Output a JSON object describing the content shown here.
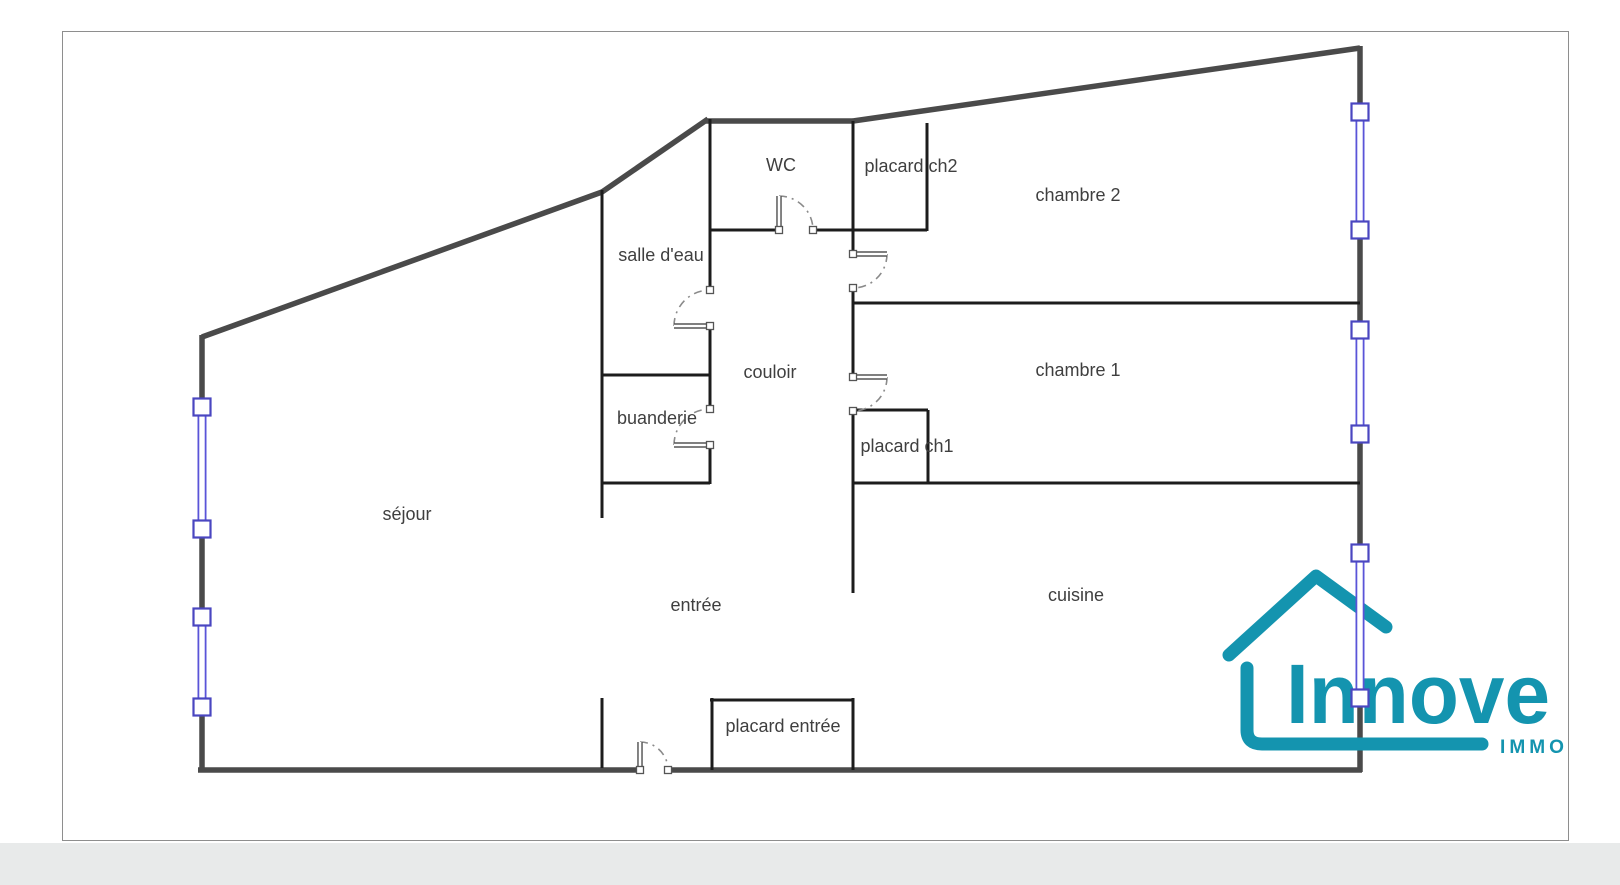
{
  "page": {
    "width": 1620,
    "height": 885,
    "background": "#ffffff",
    "bottom_band": {
      "y": 843,
      "height": 42,
      "color": "#e8eaea"
    },
    "sheet": {
      "x": 62,
      "y": 31,
      "width": 1506,
      "height": 809,
      "fill": "#ffffff",
      "border": "#8e8e8e"
    }
  },
  "colors": {
    "exterior_wall": "#4a4a4a",
    "interior_wall": "#1c1c1c",
    "window_glass": "#5a54d8",
    "window_post": "#4a46c0",
    "door": "#555555",
    "door_arc": "#8a8a8a",
    "label": "#3f3f3f",
    "logo_teal": "#1494af"
  },
  "plan": {
    "exterior_segments": [
      [
        202,
        337,
        602,
        192
      ],
      [
        602,
        192,
        708,
        119
      ],
      [
        706,
        121,
        853,
        121
      ],
      [
        853,
        121,
        1360,
        48
      ],
      [
        1360,
        46,
        1360,
        105
      ],
      [
        1360,
        238,
        1360,
        322
      ],
      [
        1360,
        442,
        1360,
        545
      ],
      [
        1360,
        707,
        1360,
        772
      ],
      [
        198,
        770,
        640,
        770
      ],
      [
        668,
        770,
        1362,
        770
      ],
      [
        202,
        335,
        202,
        400
      ],
      [
        202,
        537,
        202,
        610
      ],
      [
        202,
        715,
        202,
        772
      ]
    ],
    "interior_segments": [
      [
        602,
        190,
        602,
        518
      ],
      [
        602,
        698,
        602,
        768
      ],
      [
        710,
        119,
        710,
        290
      ],
      [
        710,
        326,
        710,
        410
      ],
      [
        710,
        445,
        710,
        484
      ],
      [
        602,
        375,
        710,
        375
      ],
      [
        602,
        483,
        710,
        483
      ],
      [
        710,
        230,
        779,
        230
      ],
      [
        815,
        230,
        855,
        230
      ],
      [
        853,
        121,
        853,
        254
      ],
      [
        853,
        288,
        853,
        304
      ],
      [
        927,
        123,
        927,
        231
      ],
      [
        853,
        230,
        927,
        230
      ],
      [
        853,
        303,
        1360,
        303
      ],
      [
        853,
        303,
        853,
        377
      ],
      [
        853,
        410,
        853,
        593
      ],
      [
        853,
        410,
        928,
        410
      ],
      [
        928,
        410,
        928,
        484
      ],
      [
        853,
        483,
        1360,
        483
      ],
      [
        712,
        698,
        712,
        770
      ],
      [
        710,
        700,
        853,
        700
      ],
      [
        853,
        698,
        853,
        770
      ]
    ],
    "windows": {
      "glass": [
        {
          "x": 202,
          "y1": 408,
          "y2": 530
        },
        {
          "x": 202,
          "y1": 618,
          "y2": 708
        },
        {
          "x": 1360,
          "y1": 120,
          "y2": 224
        },
        {
          "x": 1360,
          "y1": 336,
          "y2": 429
        },
        {
          "x": 1360,
          "y1": 560,
          "y2": 692,
          "overlay": true
        }
      ],
      "posts": [
        {
          "x": 202,
          "y": 407
        },
        {
          "x": 202,
          "y": 529
        },
        {
          "x": 202,
          "y": 617
        },
        {
          "x": 202,
          "y": 707
        },
        {
          "x": 1360,
          "y": 112
        },
        {
          "x": 1360,
          "y": 230
        },
        {
          "x": 1360,
          "y": 330
        },
        {
          "x": 1360,
          "y": 434
        },
        {
          "x": 1360,
          "y": 553,
          "overlay": true
        },
        {
          "x": 1360,
          "y": 698,
          "overlay": true
        }
      ]
    },
    "doors": [
      {
        "id": "door-wc",
        "hinge": [
          779,
          230
        ],
        "tip": [
          779,
          196
        ],
        "end": [
          813,
          230
        ]
      },
      {
        "id": "door-salle-deau",
        "hinge": [
          710,
          326
        ],
        "tip": [
          674,
          326
        ],
        "end": [
          710,
          290
        ]
      },
      {
        "id": "door-buanderie",
        "hinge": [
          710,
          445
        ],
        "tip": [
          674,
          445
        ],
        "end": [
          710,
          409
        ]
      },
      {
        "id": "door-chambre-2",
        "hinge": [
          853,
          254
        ],
        "tip": [
          887,
          254
        ],
        "end": [
          853,
          288
        ]
      },
      {
        "id": "door-chambre-1",
        "hinge": [
          853,
          377
        ],
        "tip": [
          887,
          377
        ],
        "end": [
          853,
          411
        ]
      },
      {
        "id": "door-entree",
        "hinge": [
          640,
          770
        ],
        "tip": [
          640,
          742
        ],
        "end": [
          668,
          770
        ]
      }
    ]
  },
  "rooms": [
    {
      "id": "wc",
      "label": "WC",
      "x": 781,
      "y": 166
    },
    {
      "id": "placard-ch2",
      "label": "placard ch2",
      "x": 911,
      "y": 167
    },
    {
      "id": "chambre-2",
      "label": "chambre 2",
      "x": 1078,
      "y": 196
    },
    {
      "id": "salle-deau",
      "label": "salle d'eau",
      "x": 661,
      "y": 256
    },
    {
      "id": "couloir",
      "label": "couloir",
      "x": 770,
      "y": 373
    },
    {
      "id": "chambre-1",
      "label": "chambre 1",
      "x": 1078,
      "y": 371
    },
    {
      "id": "buanderie",
      "label": "buanderie",
      "x": 657,
      "y": 419
    },
    {
      "id": "placard-ch1",
      "label": "placard ch1",
      "x": 907,
      "y": 447
    },
    {
      "id": "sejour",
      "label": "séjour",
      "x": 407,
      "y": 515
    },
    {
      "id": "entree",
      "label": "entrée",
      "x": 696,
      "y": 606
    },
    {
      "id": "cuisine",
      "label": "cuisine",
      "x": 1076,
      "y": 596
    },
    {
      "id": "placard-entree",
      "label": "placard entrée",
      "x": 783,
      "y": 727
    }
  ],
  "logo": {
    "name": "Innove",
    "tagline": "IMMO",
    "roof_path": "M 1229 655 L 1316 576 L 1386 627",
    "body_path": "M 1247 668 L 1247 730 Q 1247 744 1262 744 L 1482 744",
    "name_x": 1286,
    "name_y": 723,
    "name_size": 84,
    "name_length": 264,
    "tagline_x": 1500,
    "tagline_y": 753,
    "tagline_size": 19,
    "tagline_length": 68,
    "stroke_width": 13
  }
}
